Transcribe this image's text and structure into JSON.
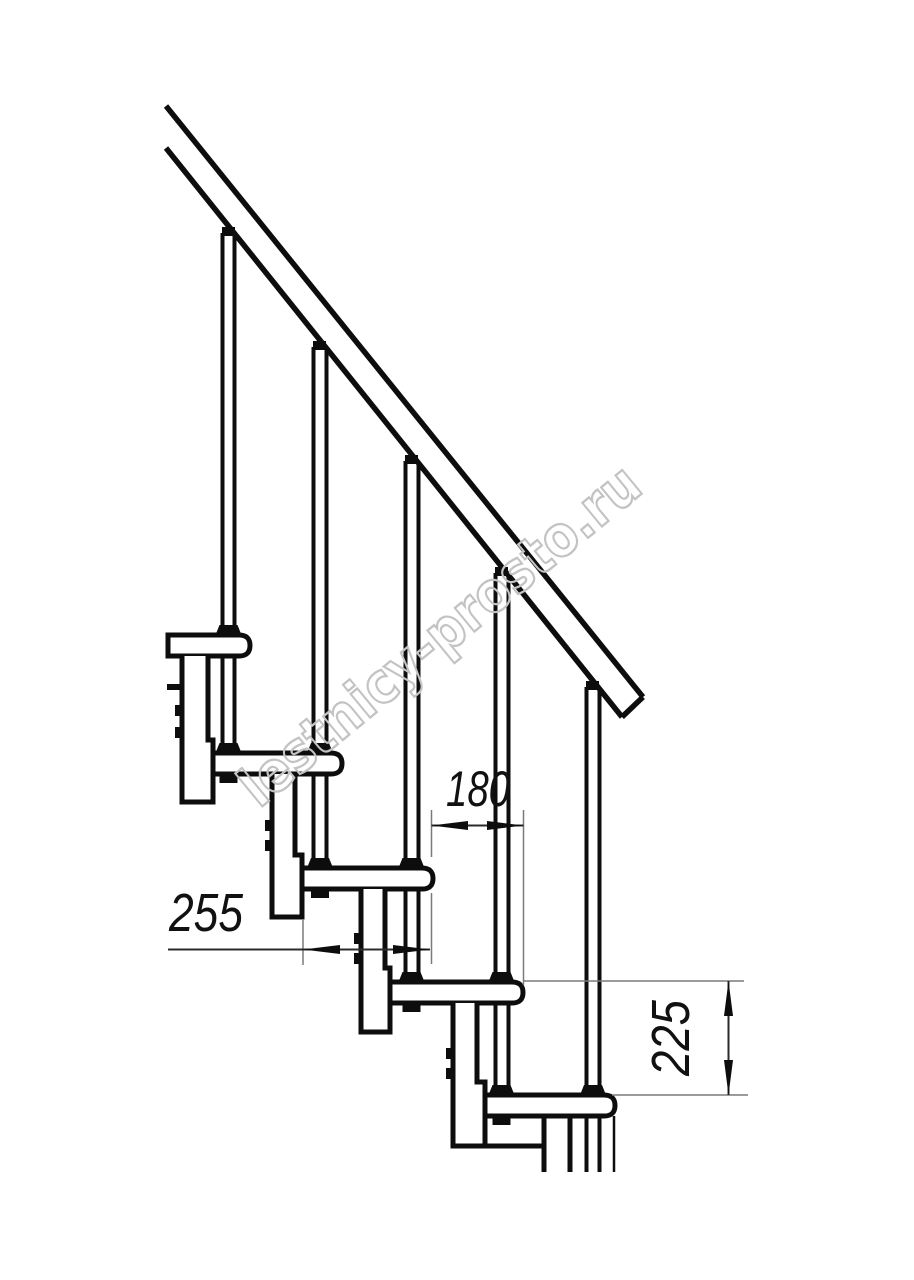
{
  "diagram": {
    "kind": "modular-staircase-side-view",
    "watermark": "lestnicy-prosto.ru",
    "dimensions": {
      "step_run": "180",
      "tread_depth": "255",
      "step_rise": "225"
    }
  }
}
